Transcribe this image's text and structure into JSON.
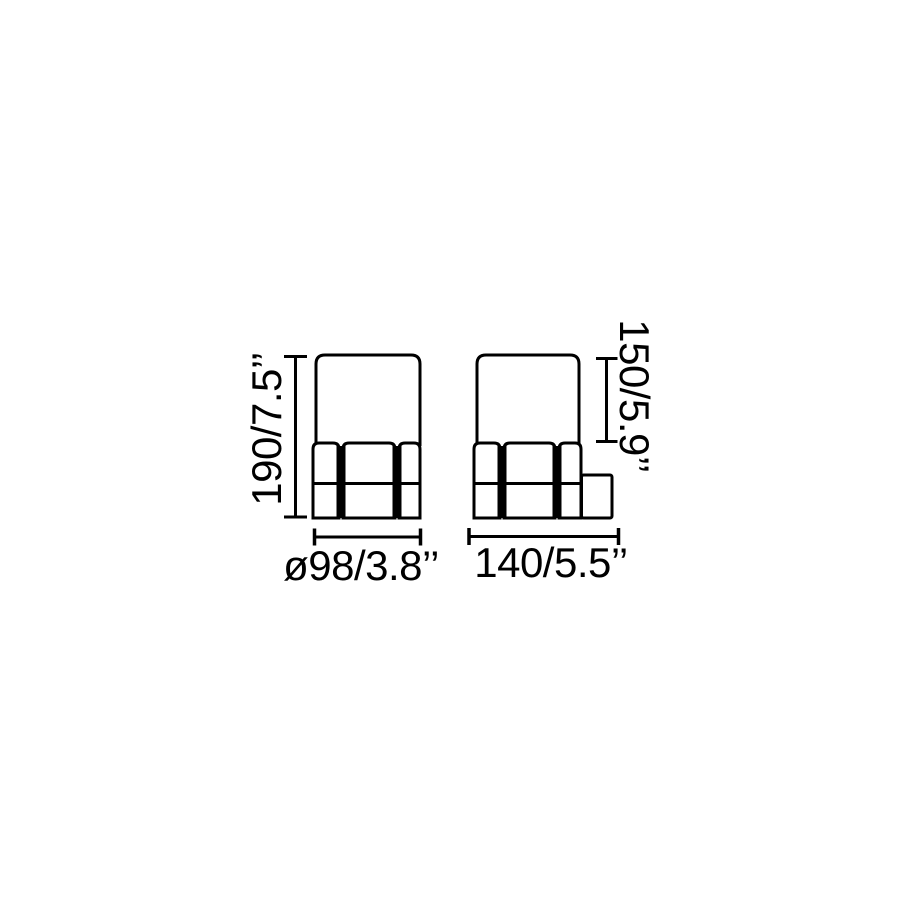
{
  "diagram": {
    "background_color": "#ffffff",
    "line_color": "#000000",
    "left_view": {
      "height_label": "190/7.5’’",
      "width_label": "ø98/3.8’’"
    },
    "right_view": {
      "height_label": "150/5.9’’",
      "width_label": "140/5.5’’"
    }
  }
}
